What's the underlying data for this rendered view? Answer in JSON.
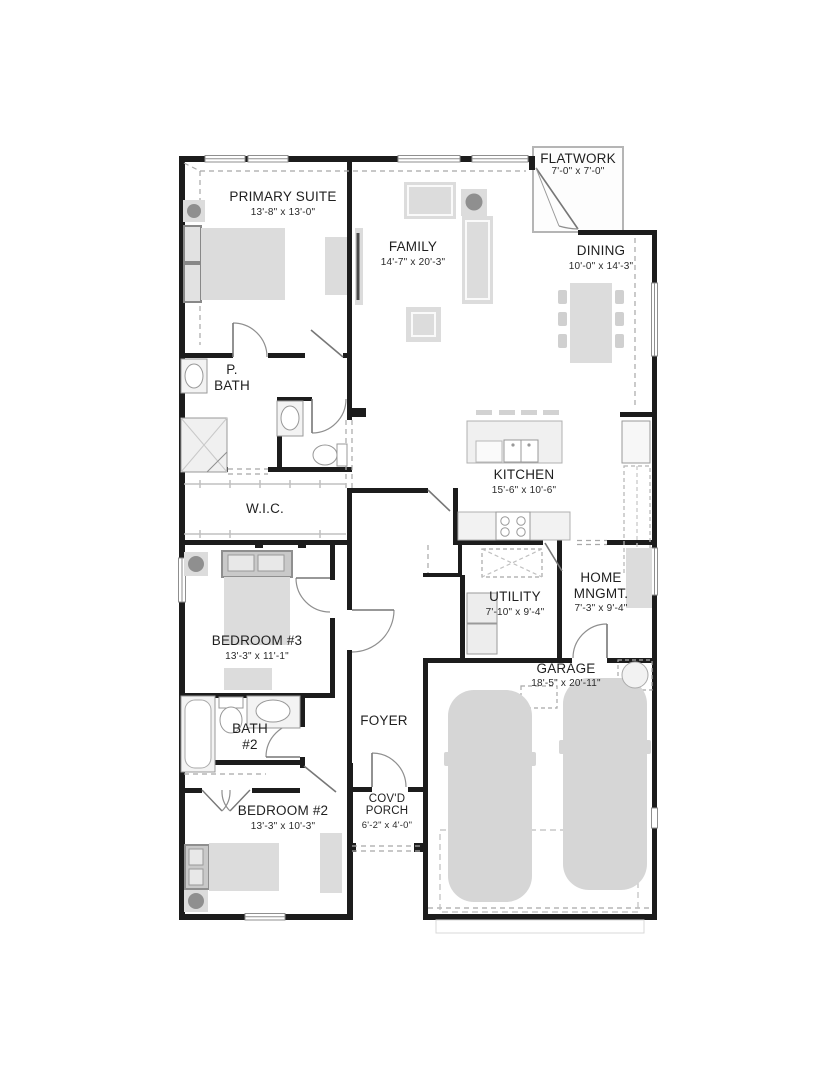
{
  "plan": {
    "type": "residential floor plan",
    "colors": {
      "wall": "#1c1c1c",
      "furniture": "#dcdcdc",
      "furniture_dark": "#8f8f8f",
      "thin_line": "#9a9a9a",
      "dash_line": "#a8a8a8",
      "background": "#ffffff"
    },
    "rooms": [
      {
        "name": "FLATWORK",
        "dims": "7'-0\" x 7'-0\""
      },
      {
        "name": "PRIMARY SUITE",
        "dims": "13'-8\" x 13'-0\""
      },
      {
        "name": "FAMILY",
        "dims": "14'-7\" x 20'-3\""
      },
      {
        "name": "DINING",
        "dims": "10'-0\" x 14'-3\""
      },
      {
        "name": "P.\nBATH",
        "dims": ""
      },
      {
        "name": "W.I.C.",
        "dims": ""
      },
      {
        "name": "KITCHEN",
        "dims": "15'-6\" x 10'-6\""
      },
      {
        "name": "BEDROOM #3",
        "dims": "13'-3\" x 11'-1\""
      },
      {
        "name": "UTILITY",
        "dims": "7'-10\" x 9'-4\""
      },
      {
        "name": "HOME\nMNGMT.",
        "dims": "7'-3\" x 9'-4\""
      },
      {
        "name": "GARAGE",
        "dims": "18'-5\" x 20'-11\""
      },
      {
        "name": "BATH\n#2",
        "dims": ""
      },
      {
        "name": "FOYER",
        "dims": ""
      },
      {
        "name": "BEDROOM #2",
        "dims": "13'-3\" x 10'-3\""
      },
      {
        "name": "COV'D\nPORCH",
        "dims": "6'-2\" x 4'-0\""
      }
    ]
  }
}
